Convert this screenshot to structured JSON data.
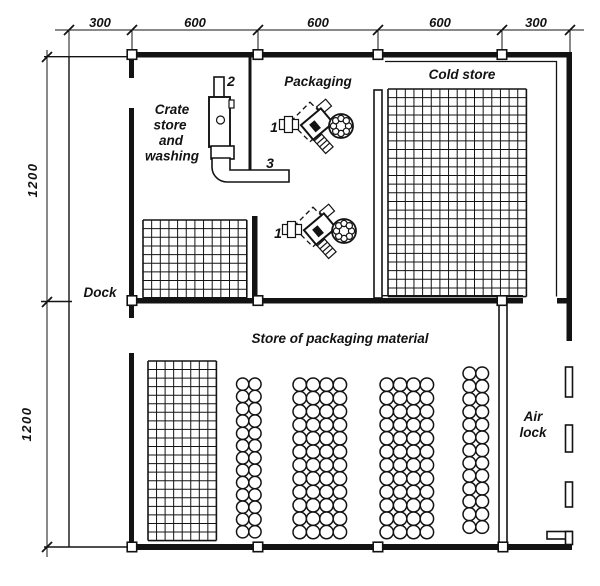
{
  "dimensions": {
    "top_labels": [
      "300",
      "600",
      "600",
      "600",
      "300"
    ],
    "left_labels": [
      "1200",
      "1200"
    ]
  },
  "rooms": {
    "crate_store": {
      "lines": [
        "Crate",
        "store",
        "and",
        "washing"
      ]
    },
    "packaging": {
      "label": "Packaging"
    },
    "cold_store": {
      "label": "Cold store"
    },
    "dock": {
      "label": "Dock"
    },
    "store_material": {
      "label": "Store of packaging material"
    },
    "air_lock": {
      "lines": [
        "Air",
        "lock"
      ]
    }
  },
  "equipment": {
    "packaging_machine_upper_label": "1",
    "packaging_machine_lower_label": "1",
    "crate_washer_label": "2",
    "conveyor_label": "3"
  },
  "storage": {
    "grids": [
      {
        "name": "cold-store-pallet-grid",
        "x": 388,
        "y": 89,
        "cols": 16,
        "rows": 24,
        "cell": 8.65
      },
      {
        "name": "crate-store-pallet-grid",
        "x": 143,
        "y": 220,
        "cols": 12,
        "rows": 9,
        "cell": 8.65
      },
      {
        "name": "packaging-material-pallet-grid",
        "x": 148,
        "y": 361,
        "cols": 8,
        "rows": 21,
        "cell": 8.55
      }
    ],
    "roll_stacks": [
      {
        "name": "roll-stack-1",
        "x": 236.5,
        "y": 378,
        "cols": 2,
        "rows": 13,
        "d": 12.3
      },
      {
        "name": "roll-stack-2",
        "x": 293,
        "y": 378,
        "cols": 4,
        "rows": 12,
        "d": 13.4
      },
      {
        "name": "roll-stack-3",
        "x": 380,
        "y": 378,
        "cols": 4,
        "rows": 12,
        "d": 13.4
      },
      {
        "name": "roll-stack-4",
        "x": 463,
        "y": 367,
        "cols": 2,
        "rows": 13,
        "d": 12.8
      }
    ]
  },
  "colors": {
    "ink": "#131313",
    "paper": "#ffffff"
  }
}
